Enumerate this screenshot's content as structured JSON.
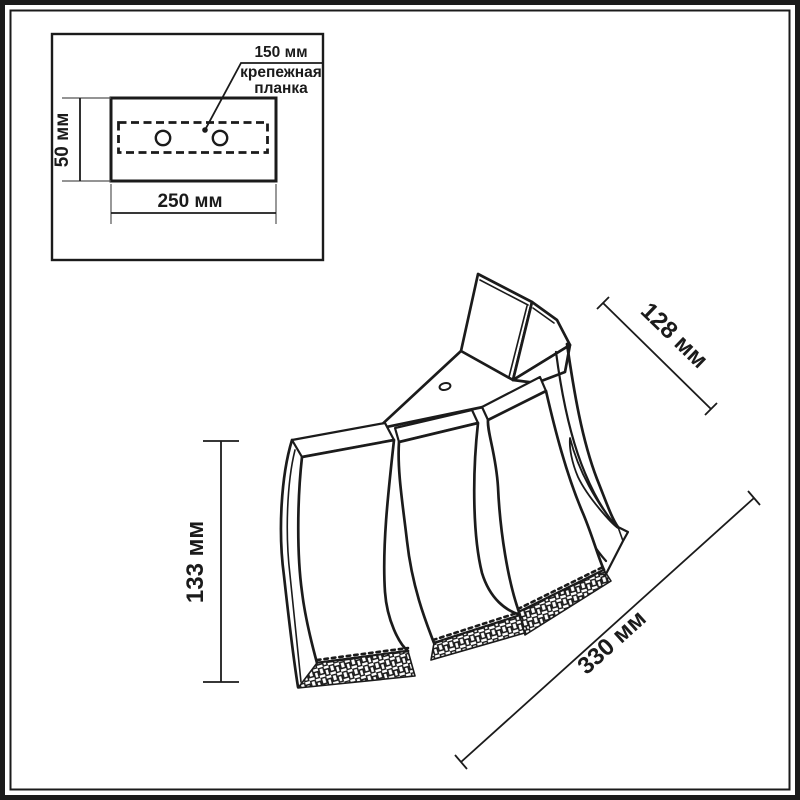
{
  "inset": {
    "dim_150": "150 мм",
    "bracket_label_line1": "крепежная",
    "bracket_label_line2": "планка",
    "dim_50": "50 мм",
    "dim_250": "250 мм"
  },
  "lamp_dims": {
    "dim_128": "128 мм",
    "dim_133": "133 мм",
    "dim_330": "330 мм"
  },
  "colors": {
    "line": "#1b1b1b",
    "background": "#ffffff"
  }
}
